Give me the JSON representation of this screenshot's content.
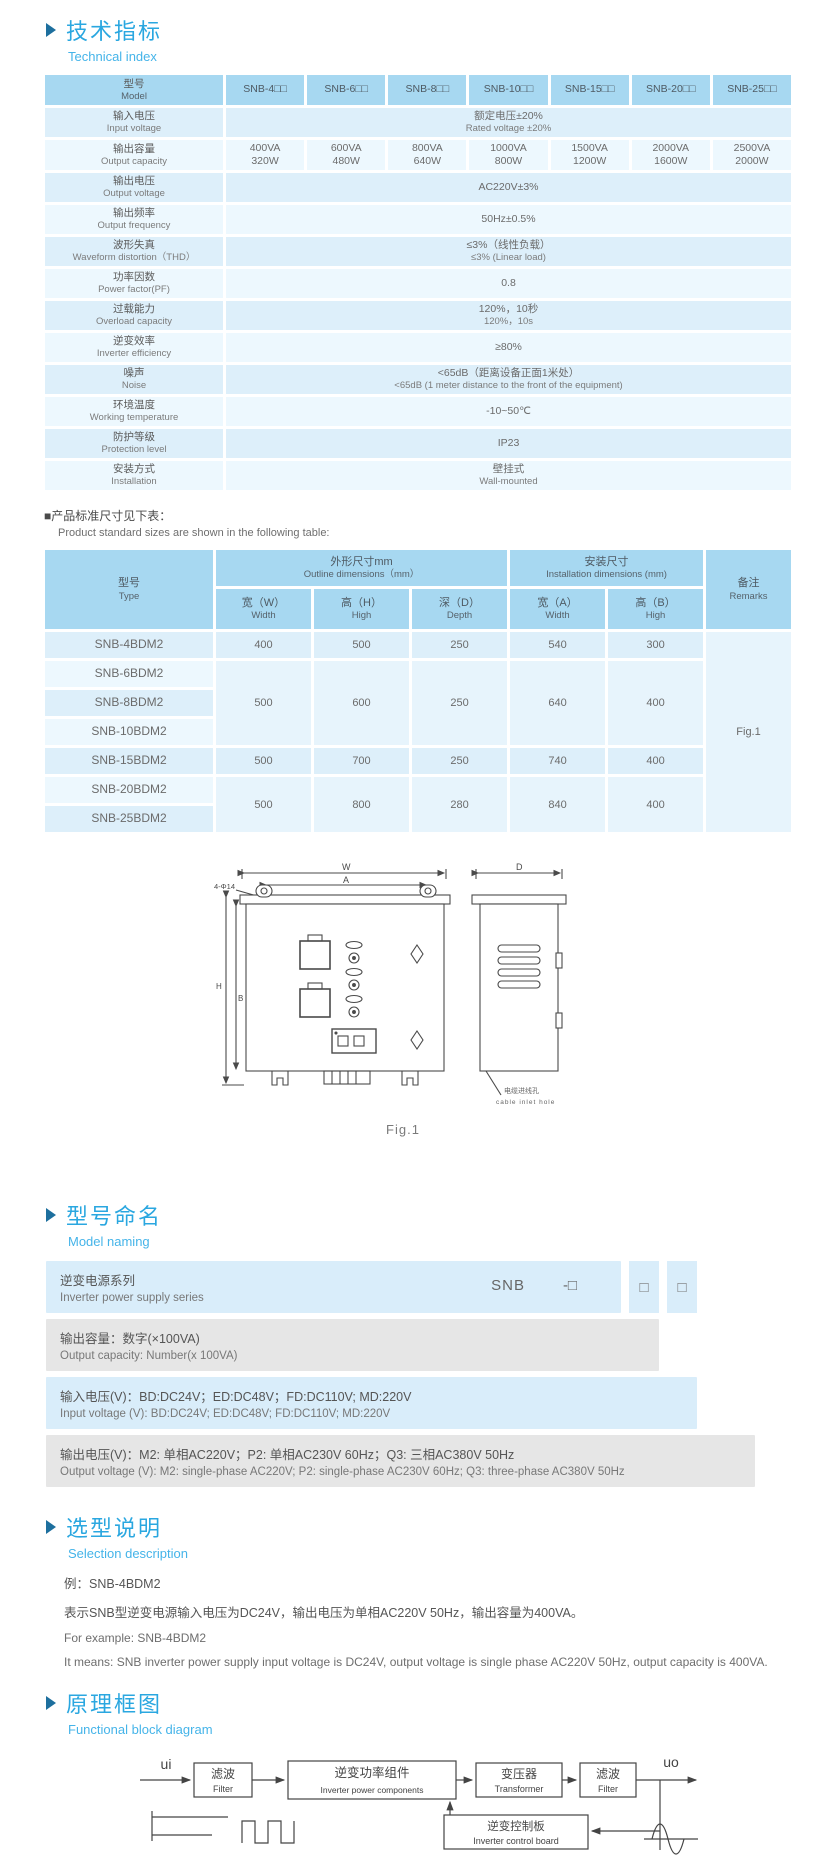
{
  "colors": {
    "accent_blue": "#2aa7e0",
    "subtitle_blue": "#45b4e9",
    "arrow_blue": "#1d6f9e",
    "table_header_bg": "#a7d8f1",
    "row_dark": "#ddeffa",
    "row_light": "#edf8fe",
    "band_blue": "#d9edfa",
    "band_gray": "#e6e6e6"
  },
  "sections": {
    "technical": {
      "zh": "技术指标",
      "en": "Technical index"
    },
    "naming": {
      "zh": "型号命名",
      "en": "Model naming"
    },
    "selection": {
      "zh": "选型说明",
      "en": "Selection description"
    },
    "block": {
      "zh": "原理框图",
      "en": "Functional block diagram"
    }
  },
  "spec_table": {
    "header": {
      "label_zh": "型号",
      "label_en": "Model",
      "models": [
        "SNB-4□□",
        "SNB-6□□",
        "SNB-8□□",
        "SNB-10□□",
        "SNB-15□□",
        "SNB-20□□",
        "SNB-25□□"
      ]
    },
    "rows": [
      {
        "zh": "输入电压",
        "en": "Input voltage",
        "value_zh": "额定电压±20%",
        "value_en": "Rated voltage ±20%"
      },
      {
        "zh": "输出容量",
        "en": "Output capacity",
        "cells": [
          [
            "400VA",
            "320W"
          ],
          [
            "600VA",
            "480W"
          ],
          [
            "800VA",
            "640W"
          ],
          [
            "1000VA",
            "800W"
          ],
          [
            "1500VA",
            "1200W"
          ],
          [
            "2000VA",
            "1600W"
          ],
          [
            "2500VA",
            "2000W"
          ]
        ]
      },
      {
        "zh": "输出电压",
        "en": "Output voltage",
        "value_zh": "AC220V±3%"
      },
      {
        "zh": "输出频率",
        "en": "Output frequency",
        "value_zh": "50Hz±0.5%"
      },
      {
        "zh": "波形失真",
        "en": "Waveform distortion（THD）",
        "value_zh": "≤3%（线性负载）",
        "value_en": "≤3% (Linear load)"
      },
      {
        "zh": "功率因数",
        "en": "Power factor(PF)",
        "value_zh": "0.8"
      },
      {
        "zh": "过载能力",
        "en": "Overload capacity",
        "value_zh": "120%，10秒",
        "value_en": "120%，10s"
      },
      {
        "zh": "逆变效率",
        "en": "Inverter efficiency",
        "value_zh": "≥80%"
      },
      {
        "zh": "噪声",
        "en": "Noise",
        "value_zh": "<65dB（距离设备正面1米处）",
        "value_en": "<65dB (1 meter distance to the front of the equipment)"
      },
      {
        "zh": "环境温度",
        "en": "Working temperature",
        "value_zh": "-10~50℃"
      },
      {
        "zh": "防护等级",
        "en": "Protection level",
        "value_zh": "IP23"
      },
      {
        "zh": "安装方式",
        "en": "Installation",
        "value_zh": "壁挂式",
        "value_en": "Wall-mounted"
      }
    ]
  },
  "sizes_note": {
    "zh": "■产品标准尺寸见下表：",
    "en": "Product standard sizes are shown in the following table:"
  },
  "size_table": {
    "type_zh": "型号",
    "type_en": "Type",
    "outline_zh": "外形尺寸mm",
    "outline_en": "Outline dimensions（mm）",
    "install_zh": "安装尺寸",
    "install_en": "Installation dimensions (mm)",
    "remarks_zh": "备注",
    "remarks_en": "Remarks",
    "sub": [
      {
        "zh": "宽（W）",
        "en": "Width"
      },
      {
        "zh": "高（H）",
        "en": "High"
      },
      {
        "zh": "深（D）",
        "en": "Depth"
      },
      {
        "zh": "宽（A）",
        "en": "Width"
      },
      {
        "zh": "高（B）",
        "en": "High"
      }
    ],
    "models": [
      "SNB-4BDM2",
      "SNB-6BDM2",
      "SNB-8BDM2",
      "SNB-10BDM2",
      "SNB-15BDM2",
      "SNB-20BDM2",
      "SNB-25BDM2"
    ],
    "groups": [
      {
        "dims": [
          "400",
          "500",
          "250",
          "540",
          "300"
        ]
      },
      {
        "dims": [
          "500",
          "600",
          "250",
          "640",
          "400"
        ]
      },
      {
        "dims": [
          "500",
          "700",
          "250",
          "740",
          "400"
        ]
      },
      {
        "dims": [
          "500",
          "800",
          "280",
          "840",
          "400"
        ]
      }
    ],
    "remark_value": "Fig.1"
  },
  "figure": {
    "caption": "Fig.1",
    "dim_w": "W",
    "dim_a": "A",
    "dim_h": "H",
    "dim_b": "B",
    "dim_d": "D",
    "hole_callout": "4-Φ14",
    "cable_zh": "电缆进线孔",
    "cable_en": "cable inlet hole"
  },
  "naming_diagram": {
    "code_prefix": "SNB",
    "code_dash": "-□",
    "code_box": "□",
    "bands": [
      {
        "zh": "逆变电源系列",
        "en": "Inverter power supply series"
      },
      {
        "zh": "输出容量：数字(×100VA)",
        "en": "Output capacity: Number(x 100VA)"
      },
      {
        "zh": "输入电压(V)：BD:DC24V；ED:DC48V；FD:DC110V; MD:220V",
        "en": "Input voltage (V): BD:DC24V; ED:DC48V; FD:DC110V; MD:220V"
      },
      {
        "zh": "输出电压(V)：M2: 单相AC220V；P2: 单相AC230V 60Hz；Q3: 三相AC380V 50Hz",
        "en": "Output voltage (V): M2: single-phase AC220V; P2: single-phase AC230V 60Hz; Q3: three-phase AC380V 50Hz"
      }
    ]
  },
  "selection": {
    "line1_zh": "例：SNB-4BDM2",
    "line2_zh": "表示SNB型逆变电源输入电压为DC24V，输出电压为单相AC220V 50Hz，输出容量为400VA。",
    "line1_en": "For example: SNB-4BDM2",
    "line2_en": "It means: SNB inverter power supply input voltage is DC24V, output voltage is single phase AC220V 50Hz, output capacity is 400VA."
  },
  "block_diagram": {
    "input_label": "ui",
    "output_label": "uo",
    "box1_zh": "滤波",
    "box1_en": "Filter",
    "box2_zh": "逆变功率组件",
    "box2_en": "Inverter power components",
    "box3_zh": "变压器",
    "box3_en": "Transformer",
    "box4_zh": "滤波",
    "box4_en": "Filter",
    "box5_zh": "逆变控制板",
    "box5_en": "Inverter control board"
  }
}
